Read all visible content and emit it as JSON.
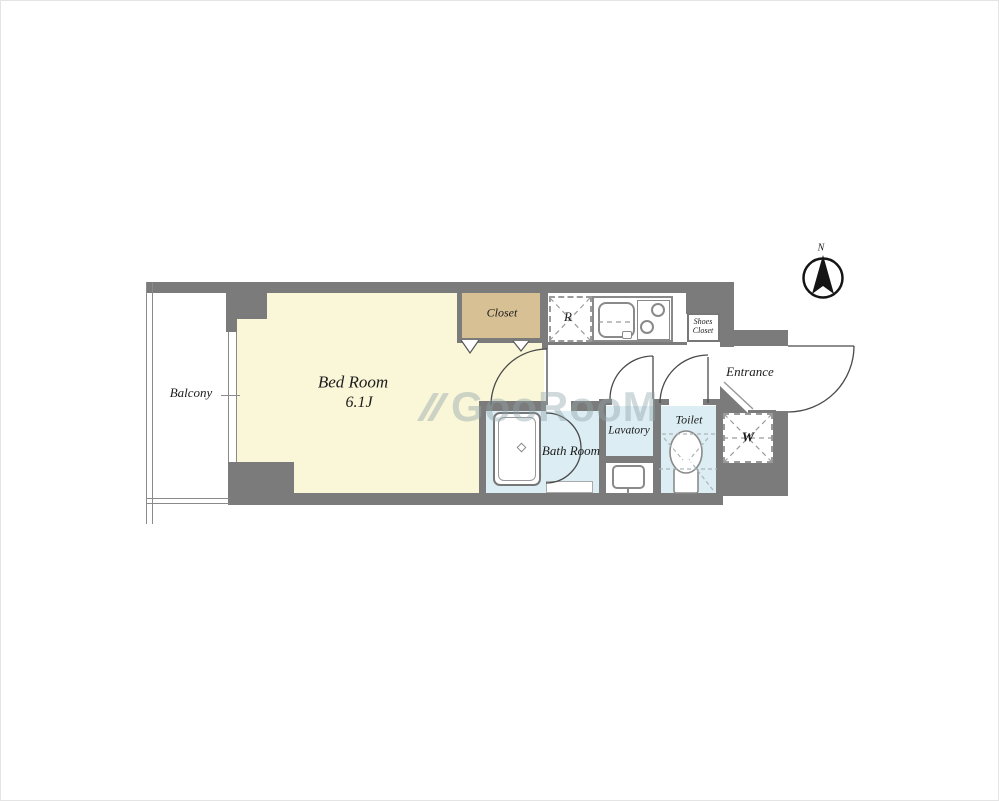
{
  "floor_plan": {
    "compass": {
      "label": "N"
    },
    "watermark": {
      "text": "GooRooM"
    },
    "rooms": {
      "balcony": {
        "label": "Balcony"
      },
      "bedroom": {
        "label": "Bed Room",
        "size": "6.1J"
      },
      "closet": {
        "label": "Closet"
      },
      "bathroom": {
        "label": "Bath Room"
      },
      "lavatory": {
        "label": "Lavatory"
      },
      "toilet": {
        "label": "Toilet"
      },
      "entrance": {
        "label": "Entrance"
      },
      "shoes_closet": {
        "line1": "Shoes",
        "line2": "Closet"
      }
    },
    "fixtures": {
      "refrigerator_space": {
        "label": "R"
      },
      "washer_space": {
        "label": "W"
      }
    },
    "colors": {
      "wall": "#7b7b7b",
      "bedroom_fill": "#faf6d8",
      "closet_fill": "#d8c095",
      "wet_area_fill": "#dcedf4",
      "watermark": "#91a5aa"
    }
  }
}
